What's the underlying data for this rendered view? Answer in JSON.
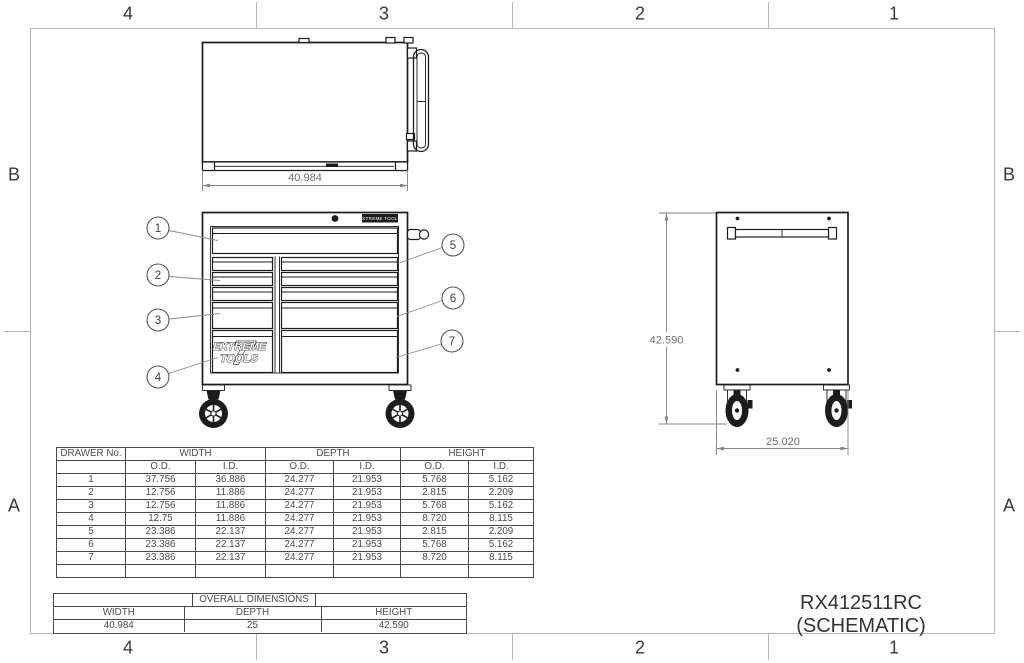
{
  "sheet": {
    "title": "RX412511RC (SCHEMATIC)"
  },
  "zones": {
    "columns": [
      "4",
      "3",
      "2",
      "1"
    ],
    "rows": [
      "B",
      "A"
    ]
  },
  "views": {
    "top": {
      "width_dim": "40.984"
    },
    "side": {
      "height_dim": "42.590",
      "depth_dim": "25.020"
    },
    "front": {
      "badge": "EXTREME TOOLS",
      "logo_initial": "T",
      "logo_line1": "EXTREME",
      "logo_line2": "TOOLS"
    }
  },
  "callouts": [
    "1",
    "2",
    "3",
    "4",
    "5",
    "6",
    "7"
  ],
  "drawer_table": {
    "col1_header": "DRAWER No.",
    "group_headers": [
      "WIDTH",
      "DEPTH",
      "HEIGHT"
    ],
    "sub_headers": [
      "O.D.",
      "I.D."
    ],
    "rows": [
      [
        "1",
        "37.756",
        "36.886",
        "24.277",
        "21.953",
        "5.768",
        "5.162"
      ],
      [
        "2",
        "12.756",
        "11.886",
        "24.277",
        "21.953",
        "2.815",
        "2.209"
      ],
      [
        "3",
        "12.756",
        "11.886",
        "24.277",
        "21.953",
        "5.768",
        "5.162"
      ],
      [
        "4",
        "12.75",
        "11.886",
        "24.277",
        "21.953",
        "8.720",
        "8.115"
      ],
      [
        "5",
        "23.386",
        "22.137",
        "24.277",
        "21.953",
        "2.815",
        "2.209"
      ],
      [
        "6",
        "23.386",
        "22.137",
        "24.277",
        "21.953",
        "5.768",
        "5.162"
      ],
      [
        "7",
        "23.386",
        "22.137",
        "24.277",
        "21.953",
        "8.720",
        "8.115"
      ]
    ]
  },
  "overall_table": {
    "title": "OVERALL DIMENSIONS",
    "headers": [
      "WIDTH",
      "DEPTH",
      "HEIGHT"
    ],
    "values": [
      "40.984",
      "25",
      "42.590"
    ]
  },
  "colors": {
    "line": "#1c1c1c",
    "dim_gray": "#828282",
    "frame_gray": "#b5b5b5",
    "table_line": "#4a4a4a"
  }
}
